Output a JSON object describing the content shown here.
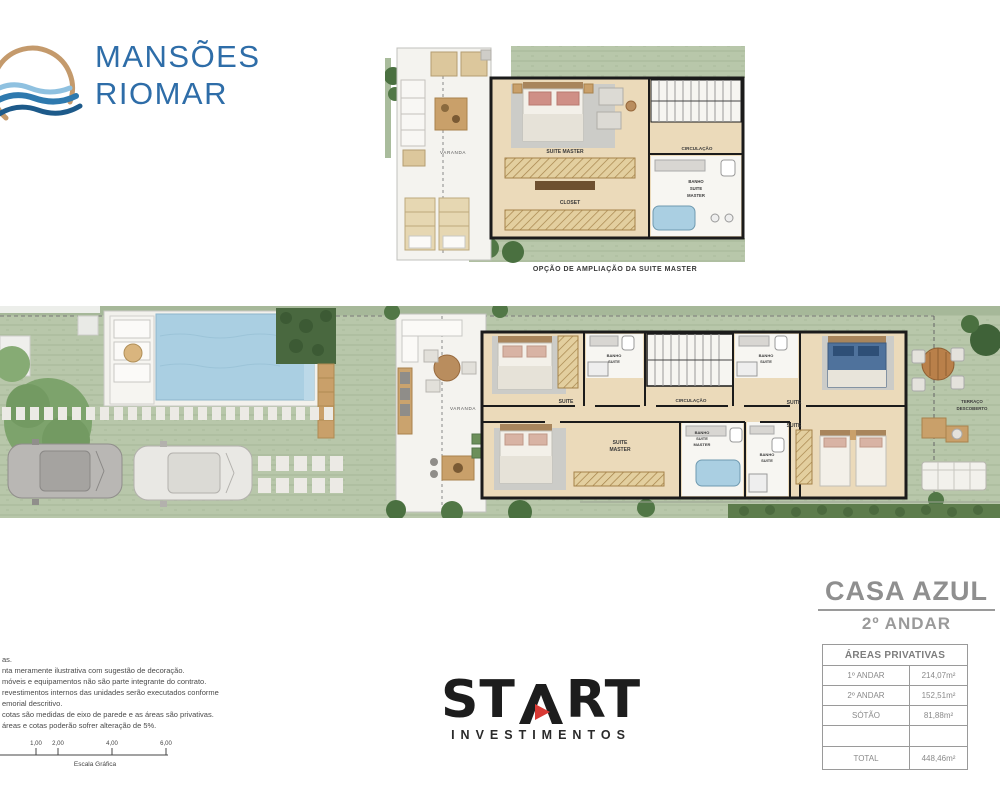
{
  "brand": {
    "line1": "MANSÕES",
    "line2": "RIOMAR"
  },
  "top_plan": {
    "caption": "OPÇÃO DE AMPLIAÇÃO DA SUITE MASTER",
    "labels": {
      "varanda": "VARANDA",
      "suite_master": "SUITE MASTER",
      "closet": "CLOSET",
      "circulacao": "CIRCULAÇÃO",
      "banho_l1": "BANHO",
      "banho_l2": "SUITE",
      "banho_l3": "MASTER"
    }
  },
  "main_plan": {
    "labels": {
      "varanda": "VARANDA",
      "suite_1": "SUITE",
      "banho_top1_l1": "BANHO",
      "banho_top1_l2": "SUITE",
      "circulacao": "CIRCULAÇÃO",
      "banho_top2_l1": "BANHO",
      "banho_top2_l2": "SUITE",
      "suite_2": "SUITE",
      "suite_master_l1": "SUITE",
      "suite_master_l2": "MASTER",
      "banho_master_l1": "BANHO",
      "banho_master_l2": "SUITE",
      "banho_master_l3": "MASTER",
      "banho_bot_l1": "BANHO",
      "banho_bot_l2": "SUITE",
      "suite_3": "SUITE",
      "terraco_l1": "TERRAÇO",
      "terraco_l2": "DESCOBERTO"
    }
  },
  "unit": {
    "title": "CASA AZUL",
    "floor": "2º ANDAR"
  },
  "areas_table": {
    "header": "ÁREAS PRIVATIVAS",
    "rows": [
      {
        "label": "1º ANDAR",
        "value": "214,07m²"
      },
      {
        "label": "2º ANDAR",
        "value": "152,51m²"
      },
      {
        "label": "SÓTÃO",
        "value": "81,88m²"
      },
      {
        "label": "",
        "value": ""
      },
      {
        "label": "TOTAL",
        "value": "448,46m²"
      }
    ]
  },
  "disclaimer": {
    "lines": [
      "as.",
      "nta meramente ilustrativa com sugestão de decoração.",
      "móveis e equipamentos não são parte integrante do contrato.",
      "revestimentos internos das unidades serão executados conforme",
      "emorial descritivo.",
      "cotas são medidas de eixo de parede e as áreas são privativas.",
      "áreas e cotas poderão sofrer alteração de 5%."
    ]
  },
  "scale_bar": {
    "ticks": [
      "1,00",
      "2,00",
      "4,00",
      "6,00"
    ],
    "caption": "Escala Gráfica"
  },
  "developer": {
    "st": "ST",
    "rt": "RT",
    "subtitle": "INVESTIMENTOS"
  },
  "colors": {
    "logo_blue": "#2e6da8",
    "logo_tan": "#c49a6c",
    "lawn": "#b8c7aa",
    "hedge": "#49683f",
    "pool": "#aacfe2",
    "wood_floor": "#ebdaba",
    "wood_deck": "#c9a06a",
    "wall": "#1b1b1b",
    "title_gray": "#8f8f8f",
    "start_red": "#d93a35"
  }
}
